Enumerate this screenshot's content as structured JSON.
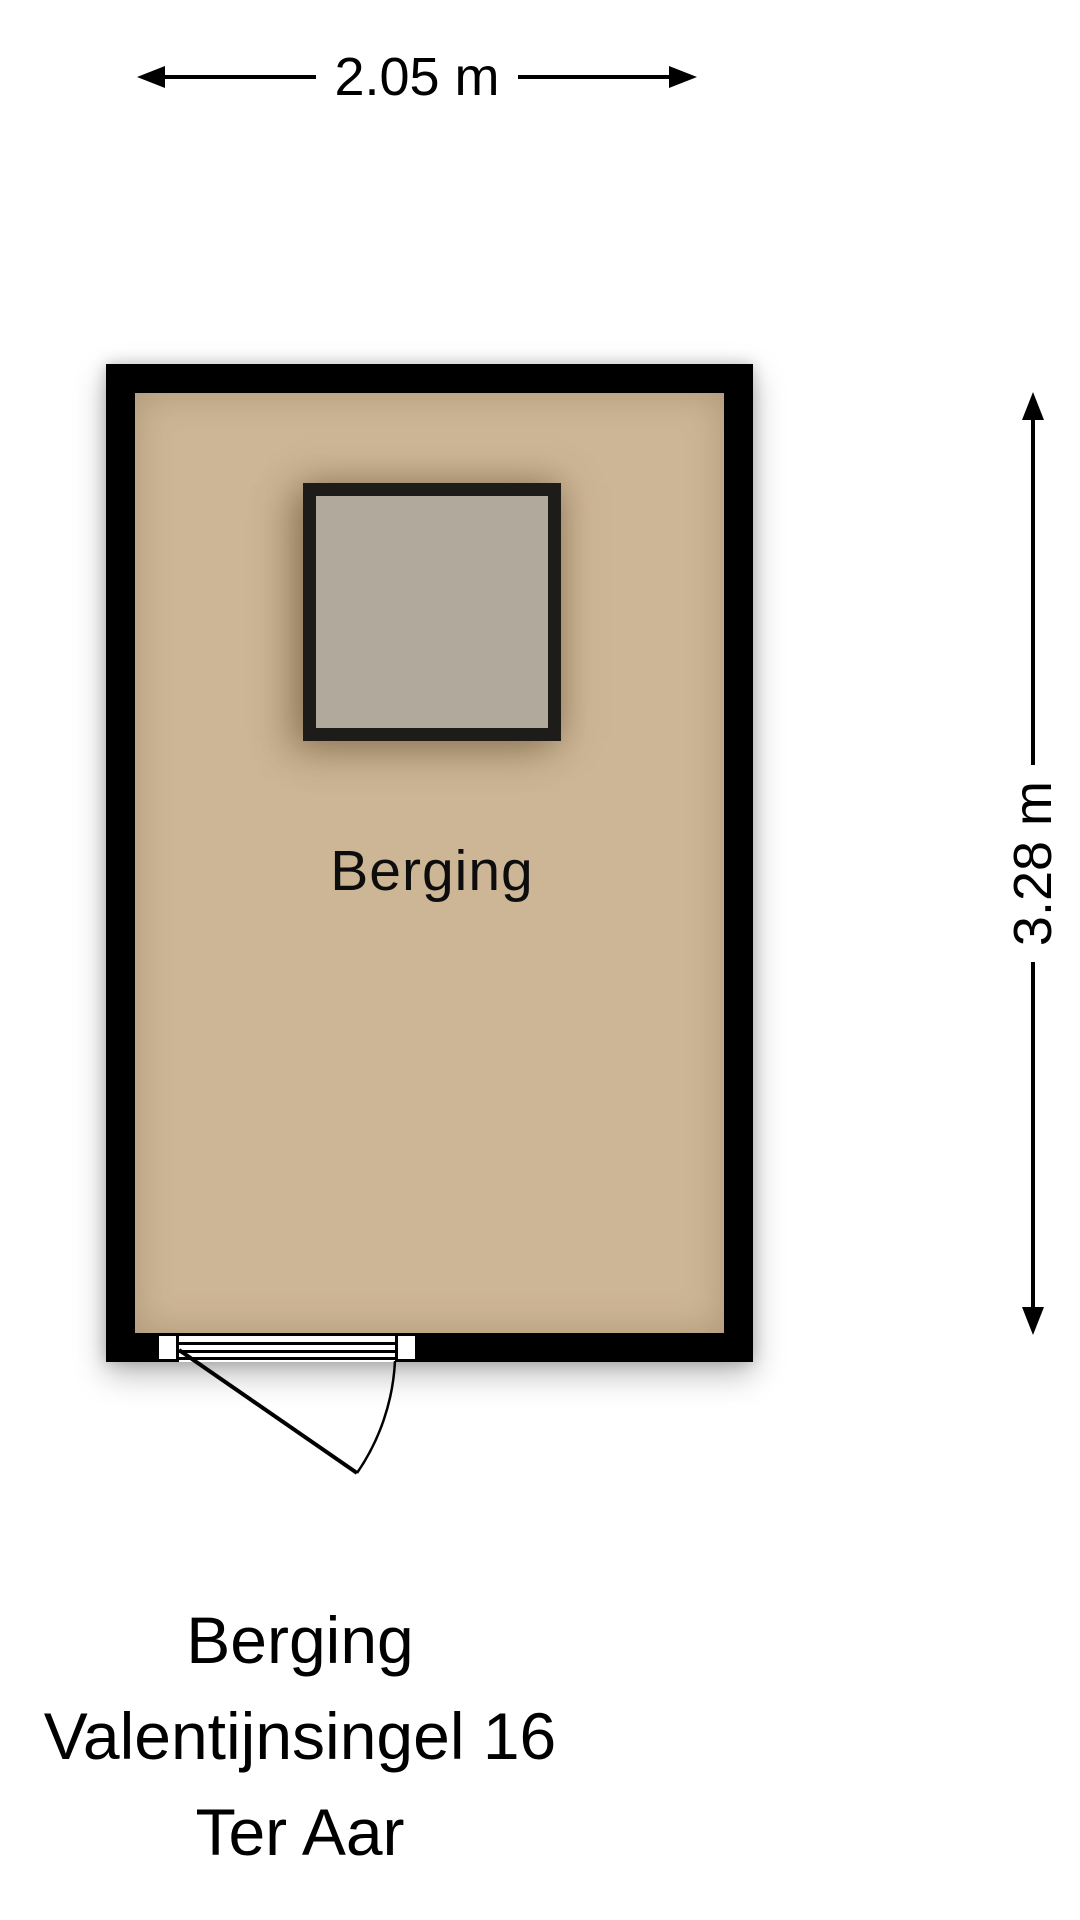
{
  "dimensions": {
    "width_label": "2.05 m",
    "height_label": "3.28 m"
  },
  "room": {
    "label": "Berging"
  },
  "caption": {
    "line1": "Berging",
    "line2": "Valentijnsingel 16",
    "line3": "Ter Aar"
  },
  "colors": {
    "wall": "#000000",
    "floor": "#cdb695",
    "skylight_fill": "#b1a99b",
    "skylight_frame": "#1e1c19",
    "line": "#000000",
    "bg": "#ffffff"
  }
}
